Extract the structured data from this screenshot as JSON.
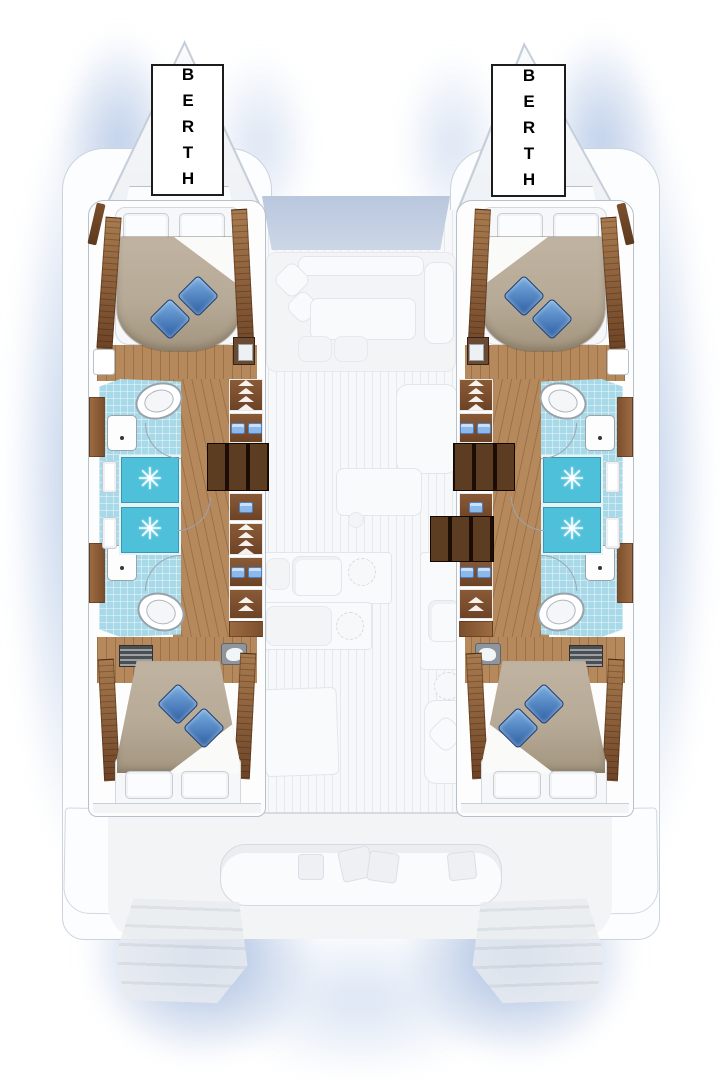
{
  "page": {
    "description": "Catamaran yacht interior layout floor plan, top view, four cabins with four heads, central salon and galley"
  },
  "labels": {
    "port_berth": "BERTH",
    "starboard_berth": "BERTH"
  },
  "icons": {
    "shower_drain_glyph": "✳"
  },
  "colors": {
    "tile": "#a7d9e9",
    "shower": "#4fc0da",
    "wood": "#b5895c",
    "wood_dark": "#7c4f2c",
    "stairs": "#1c0d04",
    "duvet": "#b7aa97",
    "pillow_blue": "#2c5da2",
    "ambient_glow": "#a8bee2",
    "windshield": "#b9c7de",
    "label_text": "#000000",
    "label_background": "#ffffff"
  }
}
